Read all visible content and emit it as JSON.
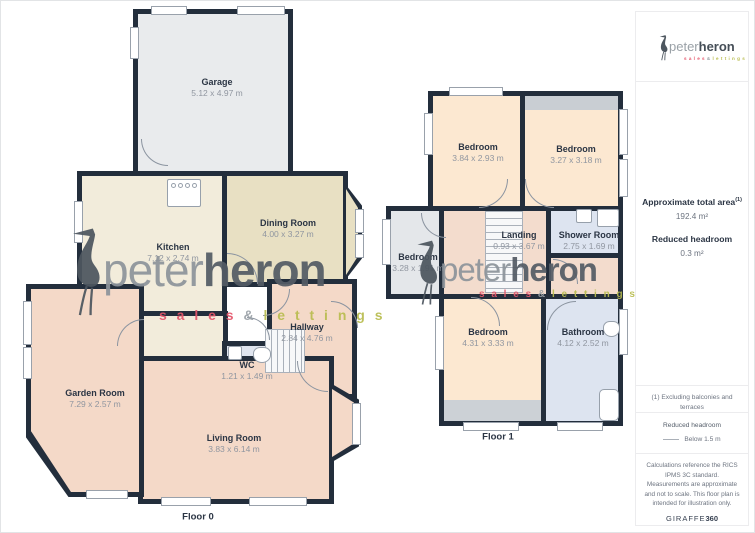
{
  "brand": {
    "name_light": "peter",
    "name_bold": "heron",
    "tagline_sales": "s a l e s",
    "tagline_amp": "&",
    "tagline_lettings": "l e t t i n g s",
    "color_sales": "#e4566b",
    "color_lettings": "#b9bd50",
    "color_wall": "#232e3c"
  },
  "floor0": {
    "label": "Floor 0",
    "rooms": {
      "garage": {
        "name": "Garage",
        "dims": "5.12 x 4.97 m"
      },
      "kitchen": {
        "name": "Kitchen",
        "dims": "7.12 x 2.74 m"
      },
      "dining": {
        "name": "Dining Room",
        "dims": "4.00 x 3.27 m"
      },
      "hallway": {
        "name": "Hallway",
        "dims": "2.84 x 4.76 m"
      },
      "wc": {
        "name": "WC",
        "dims": "1.21 x 1.49 m"
      },
      "garden": {
        "name": "Garden Room",
        "dims": "7.29 x 2.57 m"
      },
      "living": {
        "name": "Living Room",
        "dims": "3.83 x 6.14 m"
      }
    }
  },
  "floor1": {
    "label": "Floor 1",
    "rooms": {
      "bed_tl": {
        "name": "Bedroom",
        "dims": "3.84 x 2.93 m"
      },
      "bed_tr": {
        "name": "Bedroom",
        "dims": "3.27 x 3.18 m"
      },
      "bed_small": {
        "name": "Bedroom",
        "dims": "3.28 x 1.91 m"
      },
      "landing": {
        "name": "Landing",
        "dims": "0.93 x 3.67 m"
      },
      "shower": {
        "name": "Shower Room",
        "dims": "2.75 x 1.69 m"
      },
      "bed_bottom": {
        "name": "Bedroom",
        "dims": "4.31 x 3.33 m"
      },
      "bathroom": {
        "name": "Bathroom",
        "dims": "4.12 x 2.52 m"
      }
    }
  },
  "sidebar": {
    "approx_area_label": "Approximate total area",
    "approx_area_sup": "(1)",
    "approx_area_value": "192.4 m²",
    "reduced_label": "Reduced headroom",
    "reduced_value": "0.3 m²",
    "footnote": "(1) Excluding balconies and terraces",
    "legend_title": "Reduced headroom",
    "legend_item": "Below 1.5 m",
    "disclaimer": "Calculations reference the RICS IPMS 3C standard. Measurements are approximate and not to scale. This floor plan is intended for illustration only.",
    "brand_footer_name": "GIRAFFE",
    "brand_footer_num": "360"
  }
}
